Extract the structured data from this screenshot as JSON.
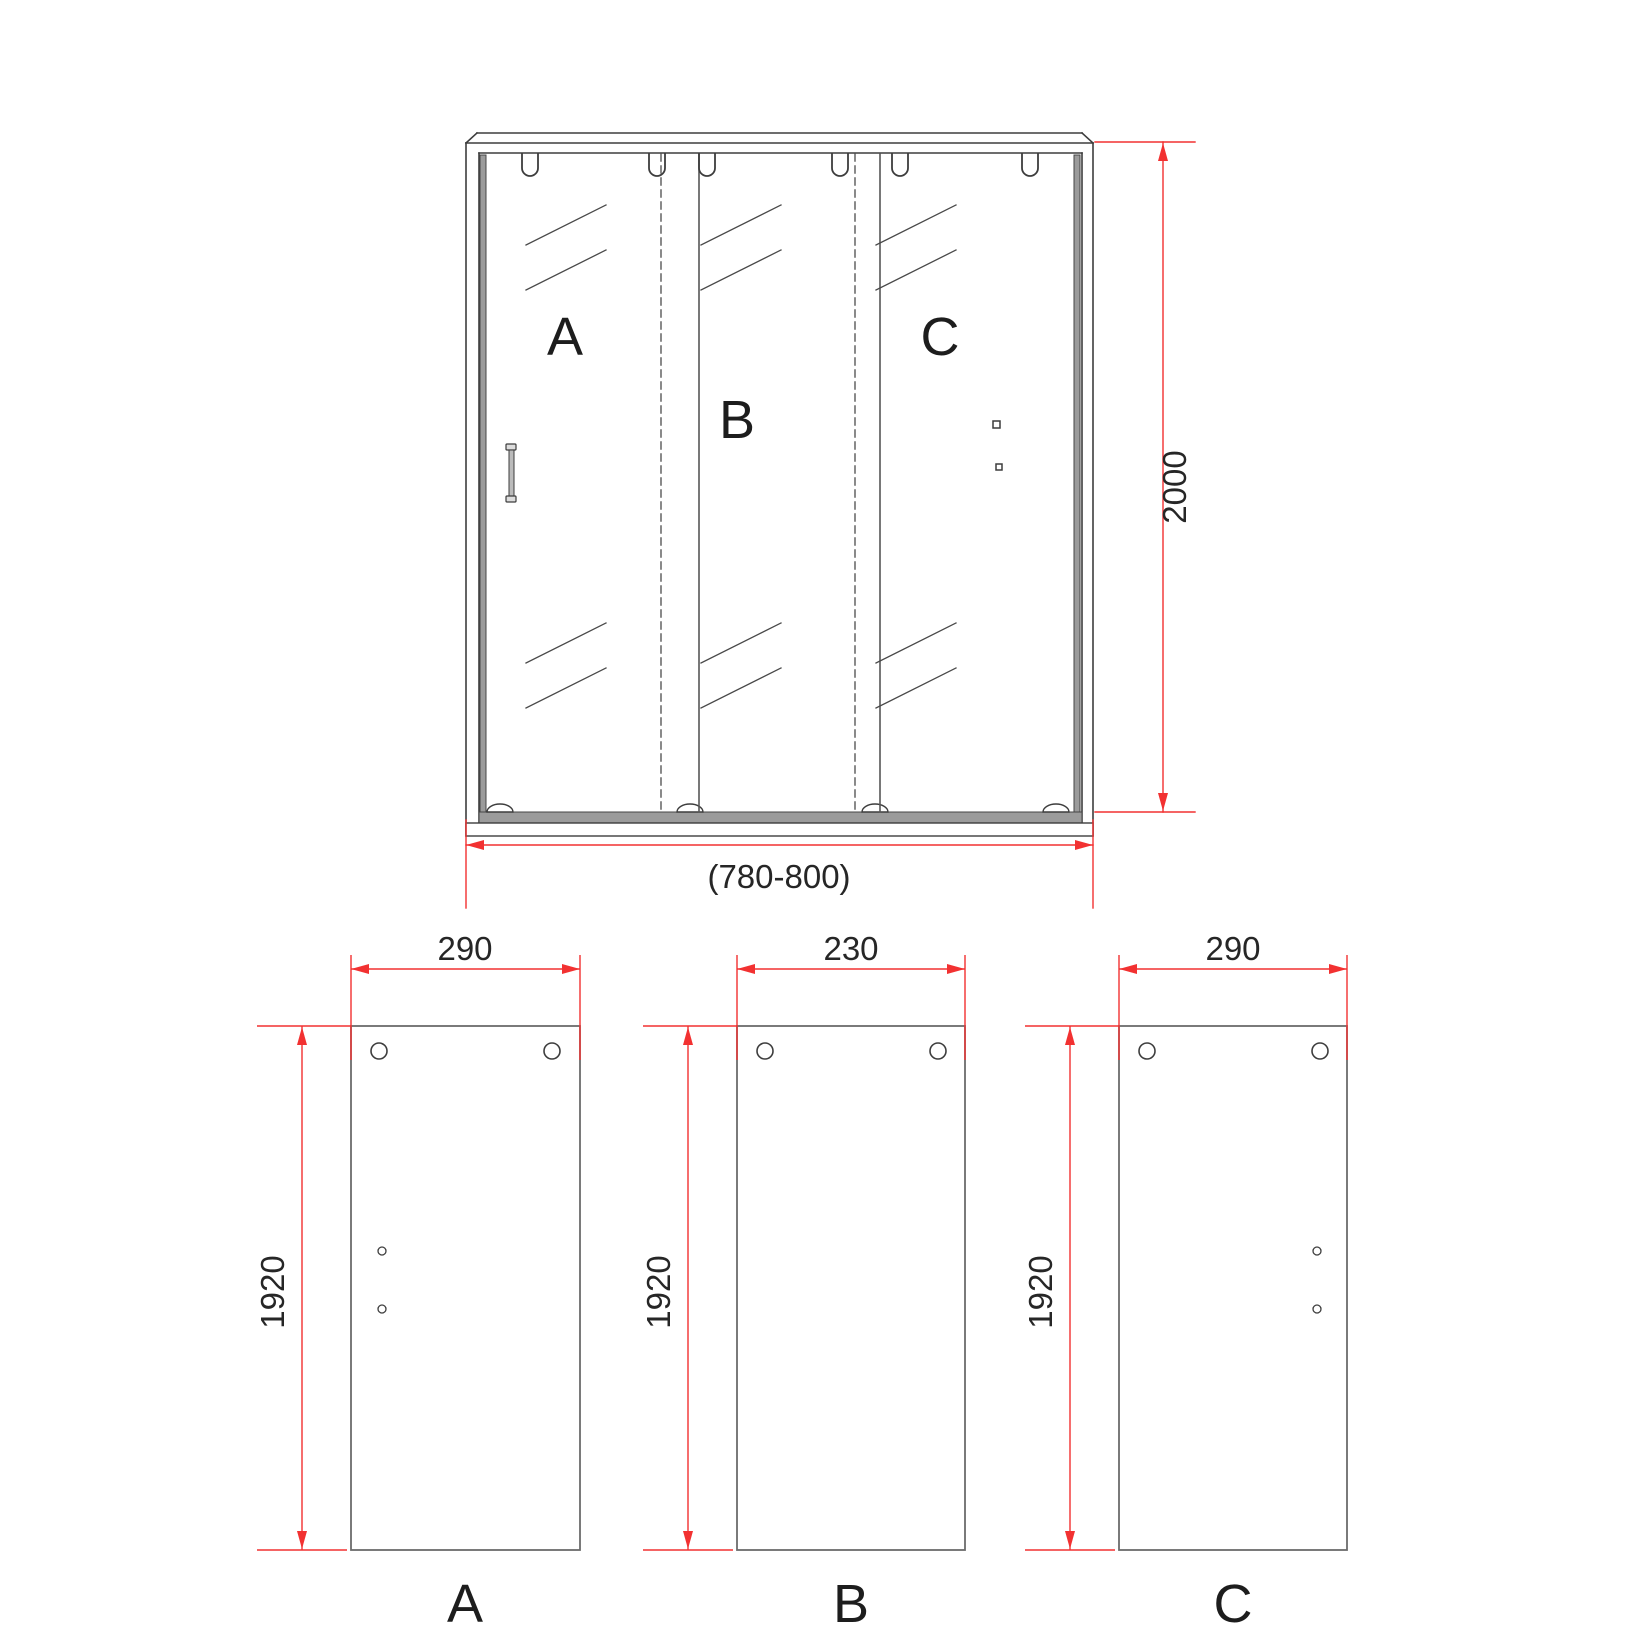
{
  "assembly": {
    "height_dim": "2000",
    "width_dim": "(780-800)",
    "panel_labels": {
      "a": "A",
      "b": "B",
      "c": "C"
    }
  },
  "cut_panels": {
    "a": {
      "label": "A",
      "width": "290",
      "height": "1920"
    },
    "b": {
      "label": "B",
      "width": "230",
      "height": "1920"
    },
    "c": {
      "label": "C",
      "width": "290",
      "height": "1920"
    }
  },
  "colors": {
    "dimension_red": "#f23131",
    "drawing_dark": "#3d3d3d",
    "panel_gray": "#6b6b6b",
    "profile_fill": "#9b9b9b"
  }
}
